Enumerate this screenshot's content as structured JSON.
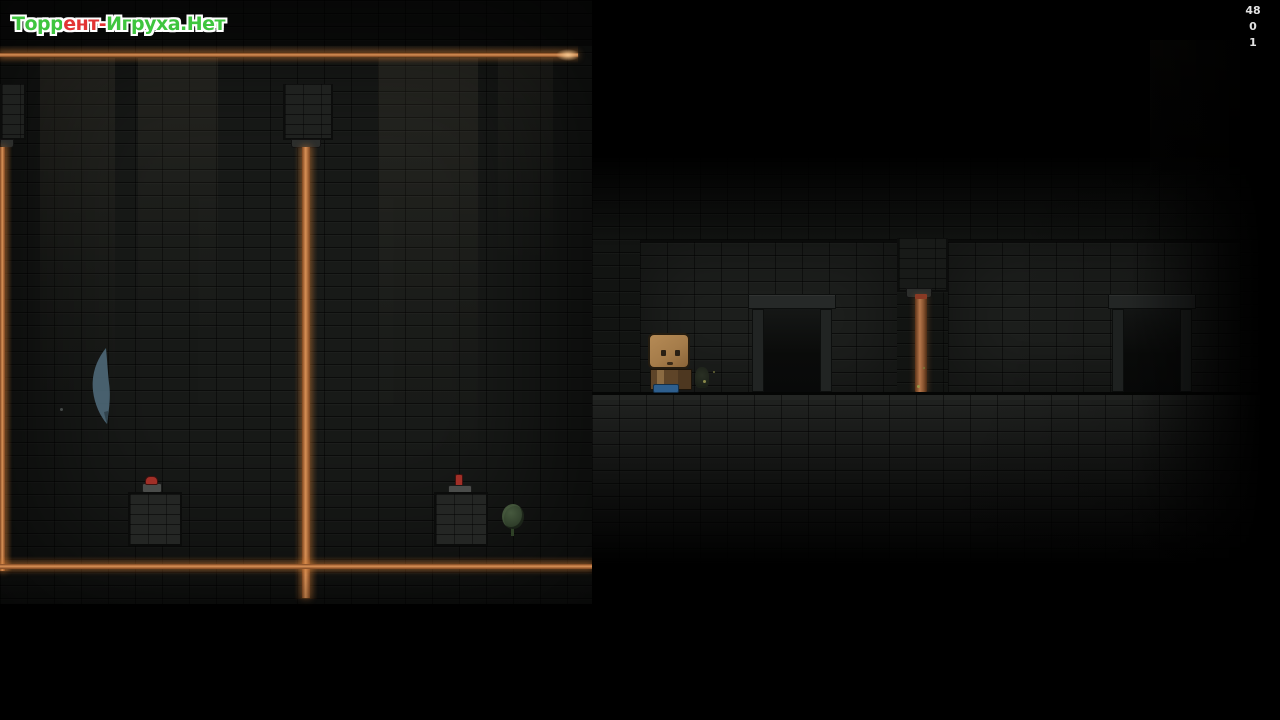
{
  "watermark": {
    "segments": [
      {
        "text": "Торр",
        "color": "green"
      },
      {
        "text": "ент-",
        "color": "red"
      },
      {
        "text": "Игруха.Нет",
        "color": "green"
      }
    ]
  },
  "hud": {
    "counters": [
      "48",
      "0",
      "1"
    ]
  },
  "palette": {
    "background": "#000000",
    "brick_wall": "#181a18",
    "recess_wall": "#1d1f1d",
    "floor": "#232523",
    "laser_core": "#d89055",
    "pipe_brown": "#b5764a",
    "character_head": "#a57c4a",
    "character_body": "#5e4428",
    "character_feet": "#2e5f8e",
    "button_red": "#a12f27",
    "plant_green": "#46593e",
    "feather_blue": "#4e6878",
    "wm_green": "#3ec53e",
    "wm_red": "#e23434",
    "hud_text": "#e2e2e2"
  }
}
